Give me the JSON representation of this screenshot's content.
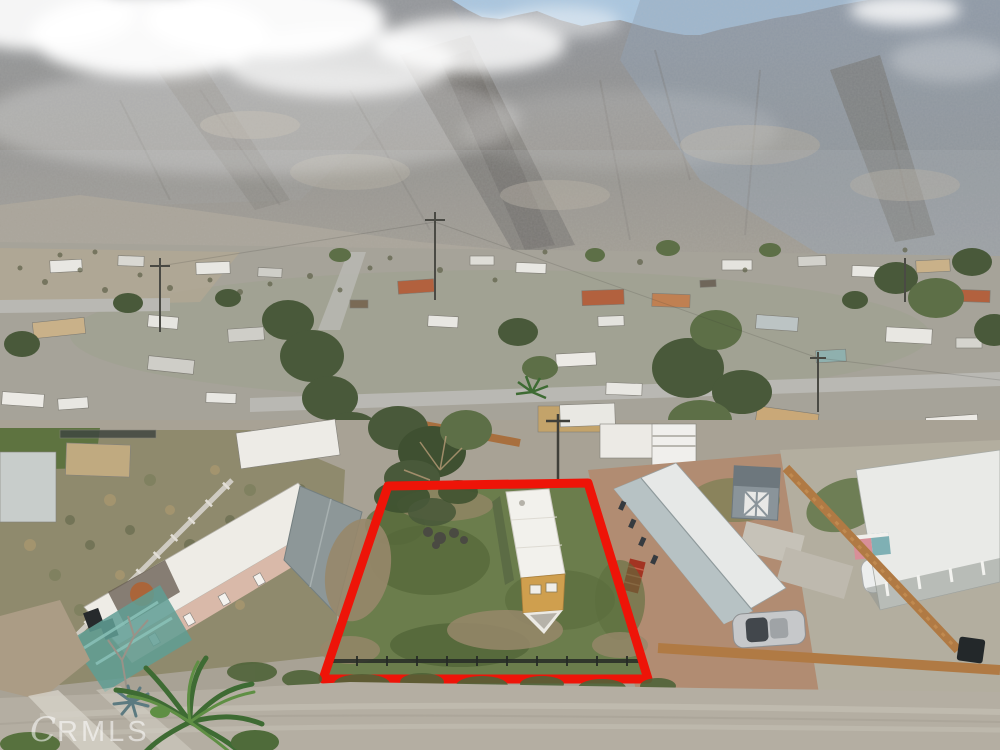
{
  "meta": {
    "kind": "aerial-drone-real-estate-photograph",
    "subject": "vacant mobile-home lot outlined in red, desert neighborhood at base of rocky mountains"
  },
  "watermark": {
    "initial": "C",
    "rest": "RMLS",
    "full": "CRMLS"
  },
  "lot": {
    "outline_points": "388,486 588,483 648,679 323,679",
    "outline_color": "#ee1408",
    "outline_width": "9"
  },
  "palette": {
    "sky": "#a9c6e0",
    "sky_glow": "#d6e4f0",
    "mountain_blue": "#8fa0b4",
    "mountain_gray": "#908d87",
    "canyon_shadow": "#6b6862",
    "foothill": "#a7a091",
    "cloud": "#ffffff",
    "valley_ground": "#a6a399",
    "road": "#b9b8b3",
    "tree_green": "#49593a",
    "tree_light": "#5d6f47",
    "lot_grass": "#6b7d4c",
    "lot_dirt": "#97876a",
    "home_roof": "#f2f1ec",
    "home_wall": "#cf9f4e",
    "left_home_roof": "#eeece6",
    "left_home_wall": "#d9b9a9",
    "carport_gray": "#8d9798",
    "right_home_white": "#e6e8e7",
    "right_home_gray": "#b7c2c4",
    "stairs_red": "#a33422",
    "shed_gray": "#8a949a",
    "wood_fence": "#b07a44",
    "gravel": "#b3ae9f",
    "terracotta": "#b18c72",
    "teal_patio": "#5f9e94",
    "dirt_road": "#b4aea2",
    "car_silver": "#c6c8ca",
    "car_white": "#eceeee"
  }
}
